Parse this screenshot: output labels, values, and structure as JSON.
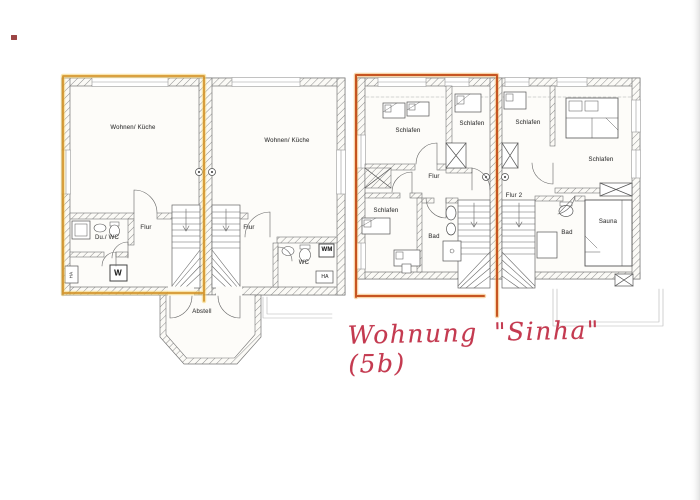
{
  "annotation": {
    "text": "Wohnung \"Sinha\" (5b)",
    "color": "#c43a50"
  },
  "marks": {
    "corner_dot_color": "#8b2424",
    "highlight_left_color": "#cf8a1c",
    "highlight_left_glow": "#f4d06a",
    "highlight_right_color": "#c14713",
    "highlight_right_glow": "#f0a952"
  },
  "ground_floor": {
    "unit_left": {
      "living": "Wohnen/ Küche",
      "hall": "Flur",
      "shower_wc": "Du./ WC",
      "washer": "W",
      "house_connection": "HA"
    },
    "unit_right": {
      "living": "Wohnen/ Küche",
      "hall": "Flur",
      "wc": "WC",
      "washer": "WM",
      "house_connection": "HA"
    },
    "storage": "Abstell"
  },
  "upper_floor": {
    "unit_left": {
      "bedroom_nw": "Schlafen",
      "bedroom_n": "Schlafen",
      "bedroom_sw": "Schlafen",
      "hall": "Flur",
      "bath": "Bad"
    },
    "unit_right": {
      "bedroom_n": "Schlafen",
      "bedroom_ne": "Schlafen",
      "hall": "Flur 2",
      "bath": "Bad",
      "sauna": "Sauna"
    }
  }
}
